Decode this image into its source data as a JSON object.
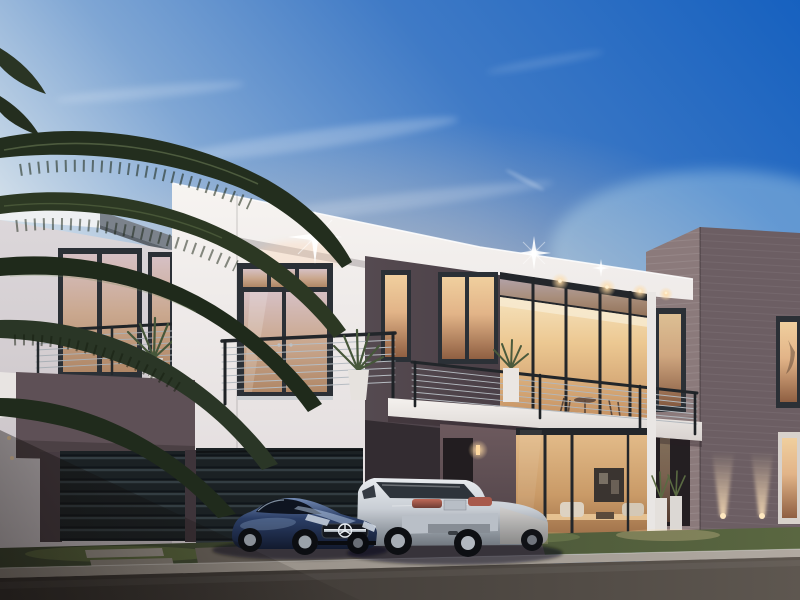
{
  "scene": {
    "type": "3d-architectural-rendering",
    "subject": "modern two-story luxury villa at dusk with two parked cars",
    "time_of_day": "dusk",
    "objects": [
      "gradient-dusk-sky",
      "wispy-clouds",
      "palm-tree-fronds",
      "white-villa-volume",
      "dark-charcoal-accent-volume",
      "brick-side-wing",
      "upper-balcony-french-doors",
      "terrace-balcony",
      "cable-railings",
      "potted-plants",
      "recessed-soffit-downlights",
      "sparkle-light-flares",
      "slatted-garage-doors",
      "mauve-concrete-wall",
      "entrance-with-sconce",
      "glass-living-room-interior",
      "wall-artwork",
      "white-planters",
      "facade-uplights",
      "lawn-strip",
      "paver-walkway",
      "street",
      "blue-mercedes-sls-coupe",
      "silver-bmw-x6-suv"
    ]
  },
  "palette": {
    "sky_deep": "#1560bf",
    "sky_mid": "#7fa6d4",
    "sky_dusk": "#eedfd4",
    "white_wall": "#f7f4f1",
    "fascia_gray": "#7b828b",
    "charcoal_wall": "#554a50",
    "mauve_wall": "#5e5056",
    "brick_lit": "#8b7a7b",
    "brick_shade": "#6c5e63",
    "window_frame": "#2b3036",
    "warm_light": "#ffd9a0",
    "glass_warm": "#e2b488",
    "grass_green": "#46513a",
    "road_asphalt": "#4a443f",
    "kerb_stone": "#b0a9a1",
    "car_blue": "#2b3e66",
    "car_silver": "#c9ced5",
    "palm_green": "#232e1e"
  }
}
